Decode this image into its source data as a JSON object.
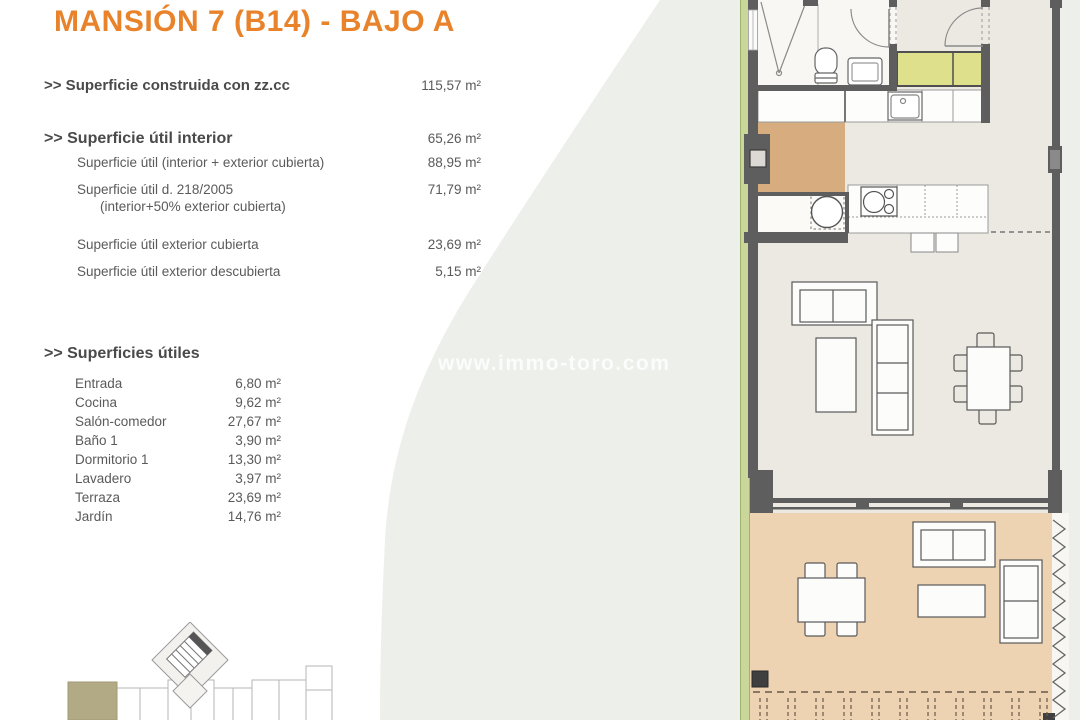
{
  "page": {
    "title": "MANSIÓN 7 (B14) - BAJO A",
    "watermark": "www.immo-toro.com"
  },
  "summary": {
    "construida": {
      "label": ">> Superficie construida con zz.cc",
      "value": "115,57 m²"
    },
    "util_interior": {
      "label": ">> Superficie útil interior",
      "value": "65,26 m²"
    },
    "util_total": {
      "label": "Superficie útil (interior + exterior cubierta)",
      "value": "88,95 m²"
    },
    "util_decreto": {
      "label": "Superficie útil d. 218/2005",
      "sublabel": "(interior+50% exterior cubierta)",
      "value": "71,79 m²"
    },
    "exterior_cubierta": {
      "label": "Superficie útil exterior cubierta",
      "value": "23,69 m²"
    },
    "exterior_descubierta": {
      "label": "Superficie útil exterior descubierta",
      "value": "5,15 m²"
    }
  },
  "rooms_heading": ">> Superficies útiles",
  "rooms": [
    {
      "label": "Entrada",
      "value": "6,80 m²"
    },
    {
      "label": "Cocina",
      "value": "9,62 m²"
    },
    {
      "label": "Salón-comedor",
      "value": "27,67 m²"
    },
    {
      "label": "Baño 1",
      "value": "3,90 m²"
    },
    {
      "label": "Dormitorio 1",
      "value": "13,30 m²"
    },
    {
      "label": "Lavadero",
      "value": "3,97 m²"
    },
    {
      "label": "Terraza",
      "value": "23,69 m²"
    },
    {
      "label": "Jardín",
      "value": "14,76 m²"
    }
  ],
  "colors": {
    "title_orange": "#E8832B",
    "swoosh_gray": "#EDEFEA",
    "wall_gray": "#5E5E5E",
    "floor_light": "#ECE9E2",
    "terrace_tan": "#EDD3B1",
    "entrance_tan": "#D7AC7E",
    "wardrobe_yellow": "#DEE08B",
    "garden_strip_green": "#CBD69B",
    "keyplan_unit_beige": "#B2A985"
  }
}
